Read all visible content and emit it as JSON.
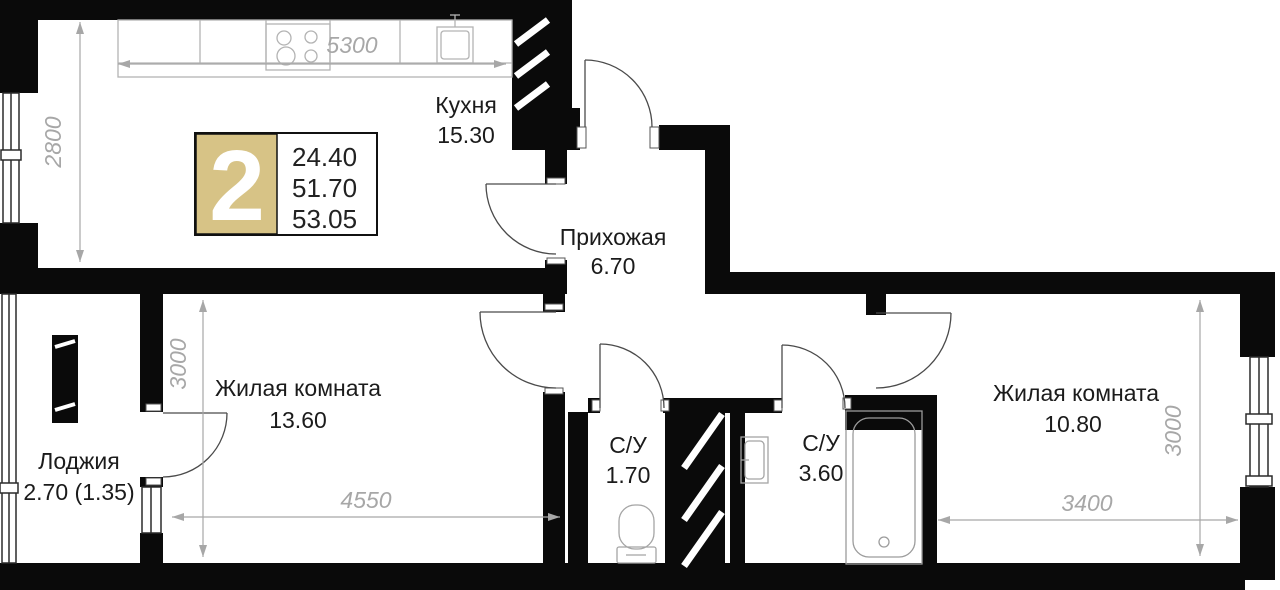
{
  "legend": {
    "room_count": "2",
    "area_living": "24.40",
    "area_main": "51.70",
    "area_total": "53.05"
  },
  "rooms": {
    "kitchen": {
      "name": "Кухня",
      "area": "15.30"
    },
    "hallway": {
      "name": "Прихожая",
      "area": "6.70"
    },
    "living_room_1": {
      "name": "Жилая комната",
      "area": "13.60"
    },
    "living_room_2": {
      "name": "Жилая комната",
      "area": "10.80"
    },
    "bathroom_1": {
      "name": "С/У",
      "area": "1.70"
    },
    "bathroom_2": {
      "name": "С/У",
      "area": "3.60"
    },
    "loggia": {
      "name": "Лоджия",
      "area": "2.70 (1.35)"
    }
  },
  "dimensions": {
    "kitchen_width_mm": "5300",
    "kitchen_depth_mm": "2800",
    "living1_depth_mm": "3000",
    "living1_width_mm": "4550",
    "living2_width_mm": "3400",
    "living2_depth_mm": "3000"
  },
  "colors": {
    "wall": "#0a0a0a",
    "accent": "#d7c386",
    "dim_text": "#a7a7a7",
    "label_text": "#1b1b1b"
  }
}
